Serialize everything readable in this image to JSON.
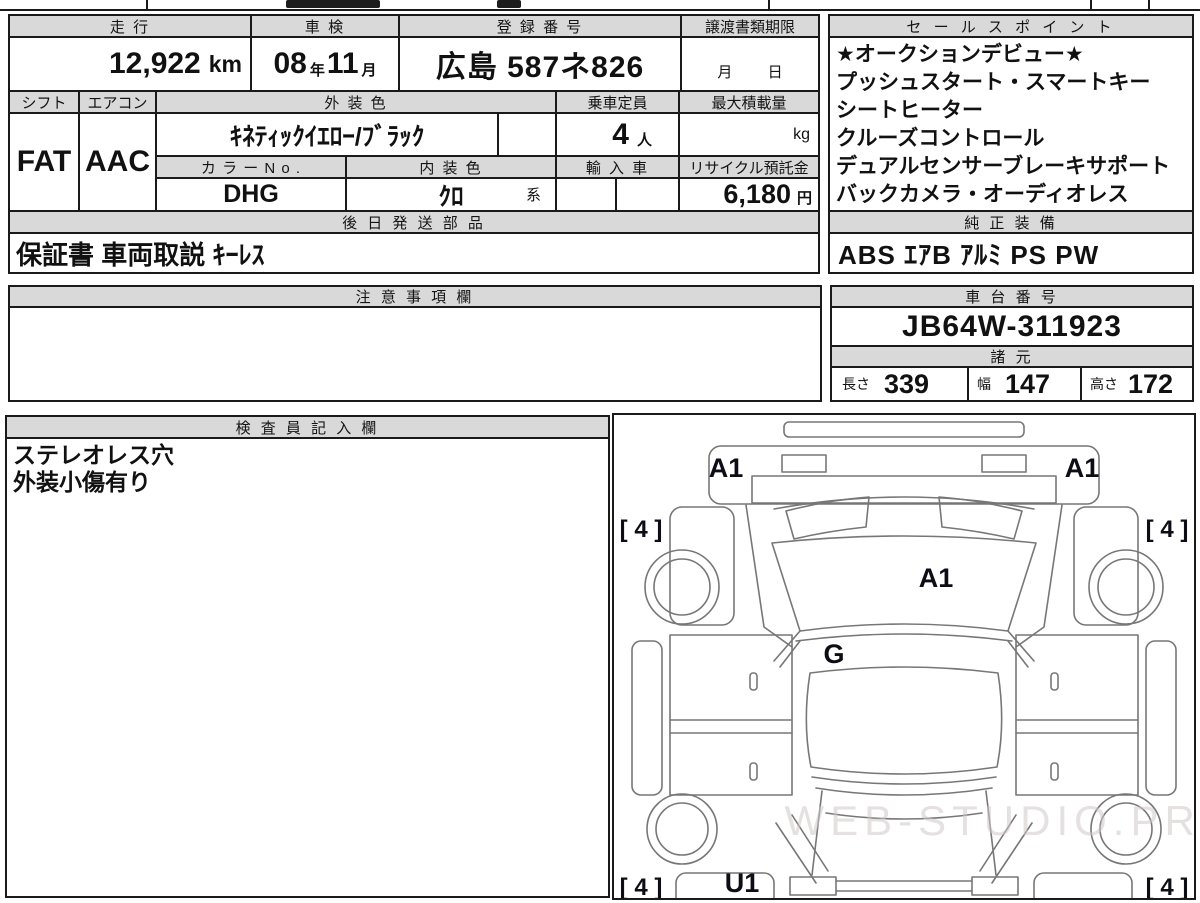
{
  "colors": {
    "header_bg": "#d9d9d9",
    "border": "#1a1a1a",
    "diagram_line": "#777777",
    "watermark_color": "#cfc8c8"
  },
  "fields": {
    "mileage": {
      "label": "走 行",
      "value": "12,922",
      "unit": "km"
    },
    "shaken": {
      "label": "車 検",
      "year": "08",
      "year_unit": "年",
      "month": "11",
      "month_unit": "月"
    },
    "registration": {
      "label": "登 録 番 号",
      "value": "広島 587ネ826"
    },
    "deadline": {
      "label": "譲渡書類期限",
      "month_label": "月",
      "day_label": "日"
    },
    "shift": {
      "label": "シフト",
      "value": "FAT"
    },
    "aircon": {
      "label": "エアコン",
      "value": "AAC"
    },
    "exterior_color": {
      "label": "外 装 色",
      "value": "ｷﾈﾃｨｯｸｲｴﾛｰ/ﾌﾞﾗｯｸ"
    },
    "capacity": {
      "label": "乗車定員",
      "value": "4",
      "unit": "人"
    },
    "max_load": {
      "label": "最大積載量",
      "unit": "kg"
    },
    "color_no": {
      "label": "カ ラ ー N o .",
      "value": "DHG"
    },
    "interior_color": {
      "label": "内 装 色",
      "value": "ｸﾛ",
      "suffix": "系"
    },
    "import_car": {
      "label": "輸 入 車"
    },
    "recycle": {
      "label": "リサイクル預託金",
      "value": "6,180",
      "unit": "円"
    },
    "later_parts": {
      "label": "後 日 発 送 部 品",
      "value": "保証書 車両取説 ｷｰﾚｽ"
    },
    "sales_points": {
      "label": "セ ー ル ス ポ イ ン ト",
      "lines": [
        "★オークションデビュー★",
        "プッシュスタート・スマートキー",
        "シートヒーター",
        "クルーズコントロール",
        "デュアルセンサーブレーキサポート",
        "バックカメラ・オーディオレス"
      ]
    },
    "equipment": {
      "label": "純 正 装 備",
      "value": "ABS ｴｱB ｱﾙﾐ PS PW"
    },
    "notes": {
      "label": "注 意 事 項 欄",
      "value": ""
    },
    "chassis": {
      "label": "車 台 番 号",
      "value": "JB64W-311923"
    },
    "specs": {
      "label": "諸 元",
      "length_label": "長さ",
      "length": "339",
      "width_label": "幅",
      "width": "147",
      "height_label": "高さ",
      "height": "172"
    },
    "inspector": {
      "label": "検 査 員 記 入 欄",
      "lines": [
        "ステレオレス穴",
        "外装小傷有り"
      ]
    }
  },
  "diagram": {
    "front_left_label": "A1",
    "front_right_label": "A1",
    "tire_front_left": "[ 4 ]",
    "tire_front_right": "[ 4 ]",
    "windshield_label": "A1",
    "hood_label": "G",
    "rear_left_label": "U1",
    "tire_rear_left": "[ 4 ]",
    "tire_rear_right": "[ 4 ]",
    "watermark": "WEB-STUDIO.PRO"
  }
}
